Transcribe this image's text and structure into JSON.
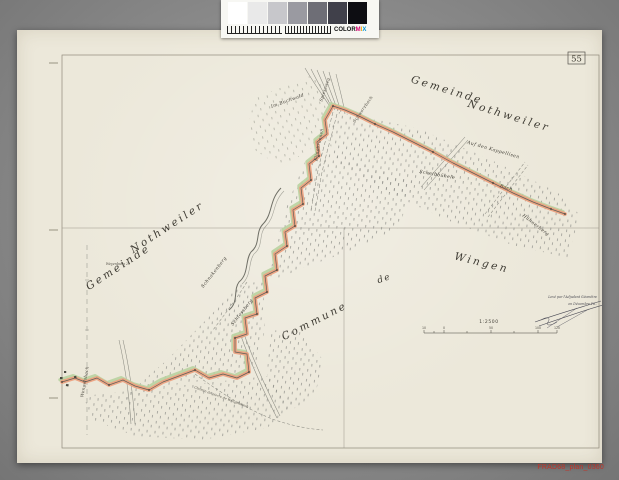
{
  "scan": {
    "filename": "FRAD68_plan_0360",
    "calibration": {
      "patches": [
        "#ffffff",
        "#e9e9e9",
        "#c7c7cb",
        "#9a9aa1",
        "#6e6e76",
        "#40404a",
        "#0d0d12"
      ],
      "logo_prefix": "COLOR",
      "logo_m": "M",
      "logo_i": "I",
      "logo_x": "X"
    }
  },
  "plan": {
    "sheet_number": "55",
    "labels": {
      "gemeinde_right": "Gemeinde",
      "nothweiler_right": "Nothweiler",
      "gemeinde_left": "Gemeinde",
      "nothweiler_left": "Nothweiler",
      "commune": "Commune",
      "de": "de",
      "wingen": "Wingen",
      "im_buchwald": "Im Buchwald",
      "kappellisen": "Auf den Kappellisen",
      "scheibbuehele": "Scheibbühele",
      "huehnerberg": "Hühnerberg",
      "bach": "Bach",
      "klingbrunnen": "Klingbrunnen",
      "spiessweg": "Spiessweg",
      "schwarzbach": "Schwarzbach",
      "schnakenberg": "Schnakenberg",
      "schlossberg": "Schlossberg",
      "wengelsbach": "Wengelsbach",
      "chemin": "Chemin de pierre de Wengelsbach",
      "weyenburg": "Weyenburg 29"
    },
    "scale": {
      "ratio": "1:2500",
      "ticks": [
        "10",
        "0",
        "50",
        "100",
        "120"
      ]
    },
    "note": {
      "line1": "Levé par l'Adjudant Géomètre",
      "line2": "en Décembre 18.."
    },
    "colors": {
      "boundary_orange": "#eca17f",
      "boundary_green": "#b9d2a0",
      "paper": "#ece8da"
    }
  }
}
